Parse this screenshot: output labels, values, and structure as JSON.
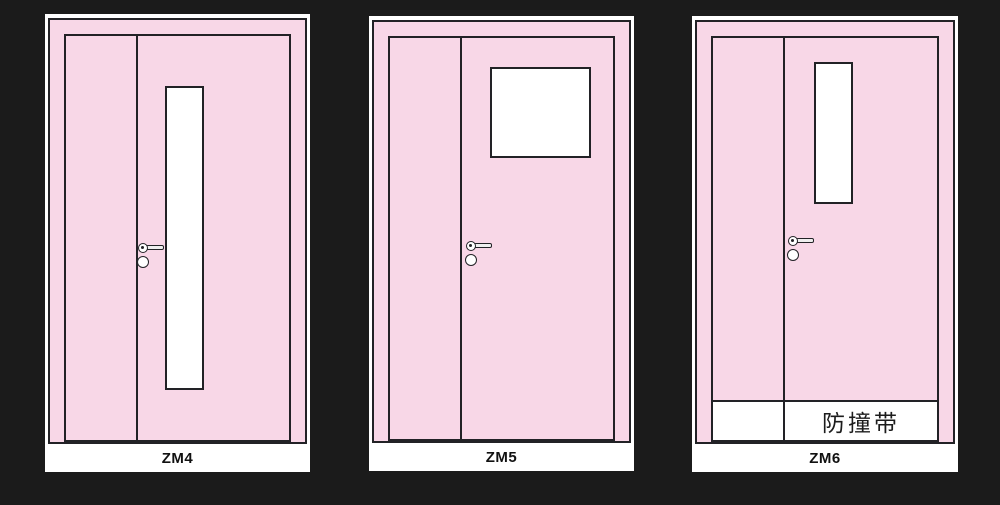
{
  "colors": {
    "background": "#1b1b1b",
    "door_pink": "#f8d7e7",
    "outline": "#222226",
    "glass_white": "#ffffff"
  },
  "doors": [
    {
      "label": "ZM4",
      "vision_panel": "narrow-vertical-glass"
    },
    {
      "label": "ZM5",
      "vision_panel": "square-window-glass"
    },
    {
      "label": "ZM6",
      "vision_panel": "narrow-vertical-glass",
      "band_label": "防撞带"
    }
  ],
  "icons": {
    "handle": "door-handle-icon",
    "lock": "lock-cylinder-icon"
  }
}
